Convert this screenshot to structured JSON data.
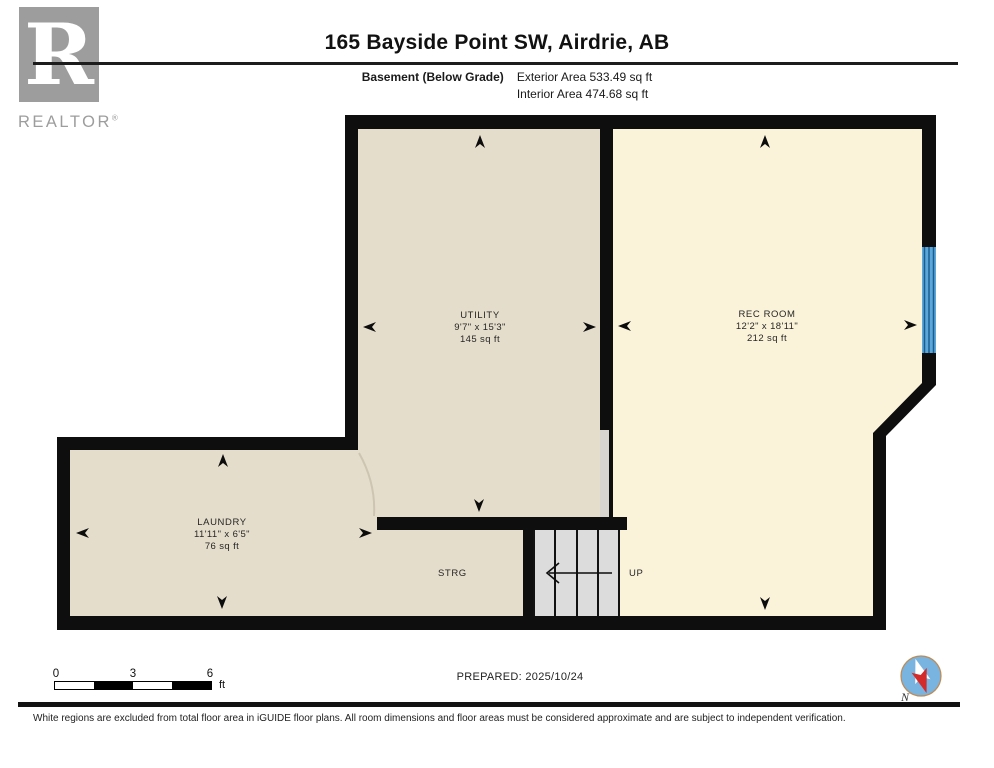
{
  "header": {
    "title": "165 Bayside Point SW, Airdrie, AB",
    "floor_label": "Basement (Below Grade)",
    "exterior_area": "Exterior Area 533.49 sq ft",
    "interior_area": "Interior Area 474.68 sq ft"
  },
  "logo": {
    "letter": "R",
    "brand": "REALTOR",
    "registered": "®"
  },
  "rooms": {
    "utility": {
      "name": "UTILITY",
      "dims": "9'7\" x 15'3\"",
      "area": "145 sq ft"
    },
    "rec_room": {
      "name": "REC ROOM",
      "dims": "12'2\" x 18'11\"",
      "area": "212 sq ft"
    },
    "laundry": {
      "name": "LAUNDRY",
      "dims": "11'11\" x 6'5\"",
      "area": "76 sq ft"
    },
    "storage": {
      "name": "STRG"
    },
    "stairs": {
      "direction_label": "UP"
    }
  },
  "scale_bar": {
    "tick_0": "0",
    "tick_3": "3",
    "tick_6": "6",
    "unit": "ft"
  },
  "compass": {
    "label": "N"
  },
  "footer": {
    "prepared": "PREPARED: 2025/10/24",
    "disclaimer": "White regions are excluded from total floor area in iGUIDE floor plans. All room dimensions and floor areas must be considered approximate and are subject to independent verification."
  },
  "colors": {
    "floor_beige": "#e5ddcb",
    "floor_cream": "#faf3da",
    "stair_gray": "#dcdcdc",
    "door_gap_gray": "#d8d5d0",
    "window_blue": "#5ca7d9",
    "window_line": "#1c5d8f",
    "wall_black": "#0e0e0e",
    "logo_gray": "#9d9d9d"
  }
}
